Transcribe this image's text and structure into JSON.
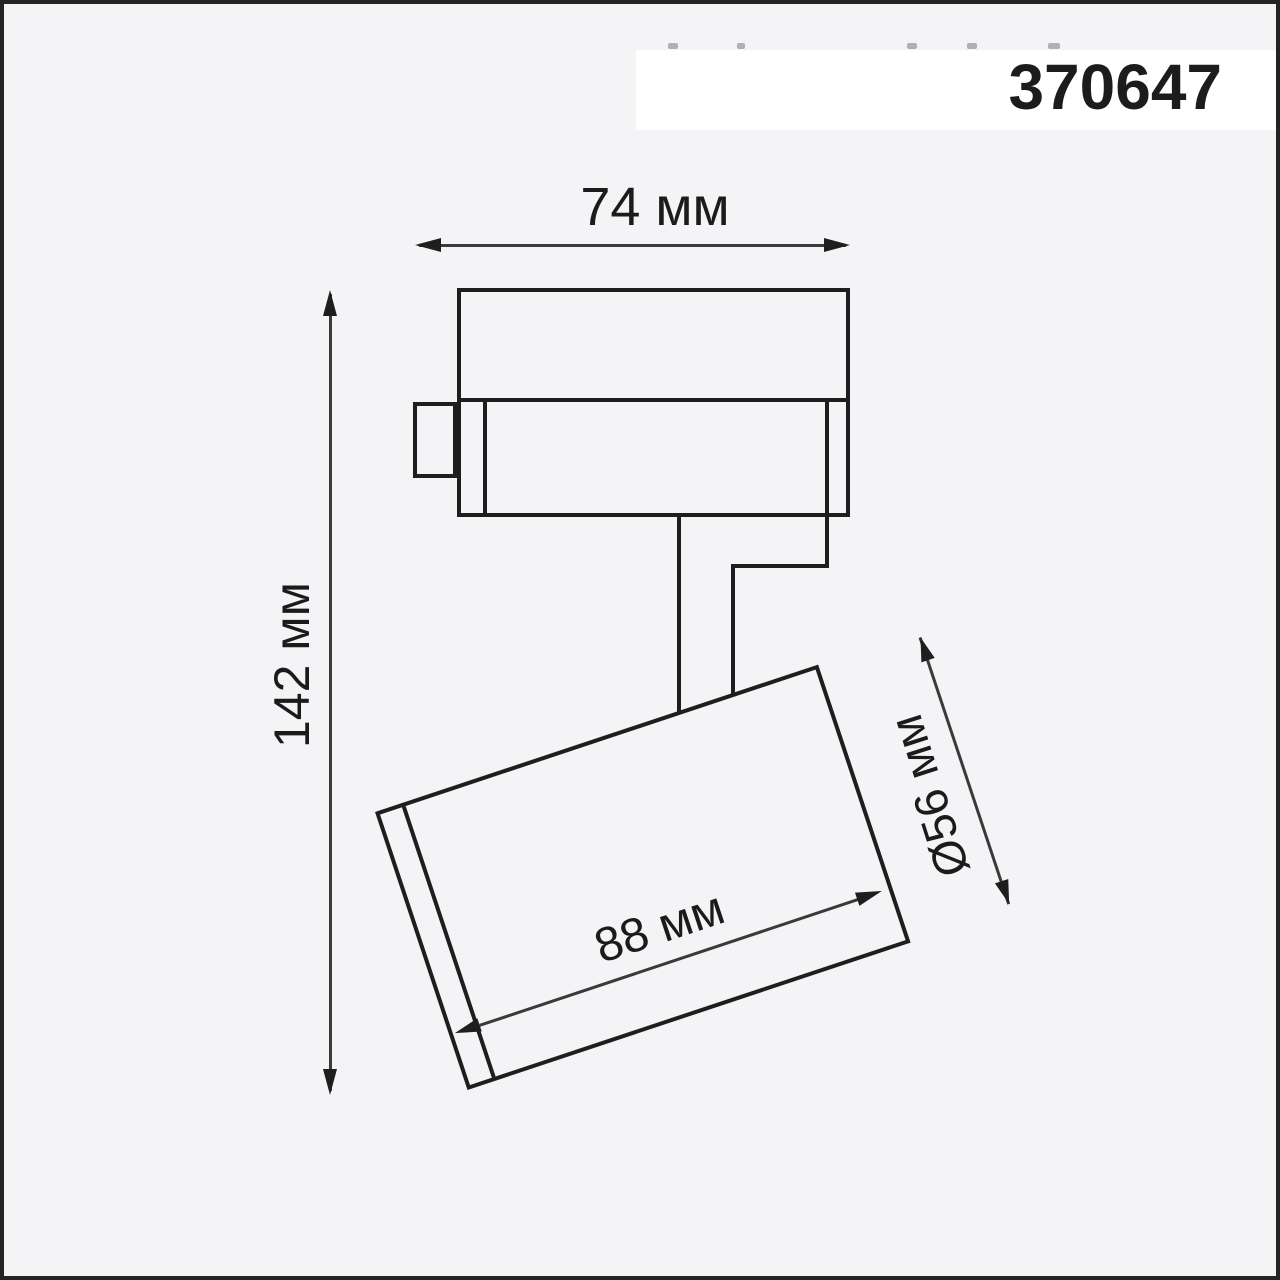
{
  "header": {
    "article_number": "370647"
  },
  "diagram": {
    "type": "product-dimension-drawing",
    "labels": {
      "width": "74 мм",
      "height": "142 мм",
      "body_length": "88 мм",
      "body_diameter": "Ø56 мм"
    },
    "colors": {
      "background": "#f4f4f6",
      "frame_border": "#232323",
      "stroke": "#1e1e1e",
      "dimension_line": "#3a3a3a",
      "header_band": "#ffffff",
      "text": "#1b1b1b"
    }
  }
}
